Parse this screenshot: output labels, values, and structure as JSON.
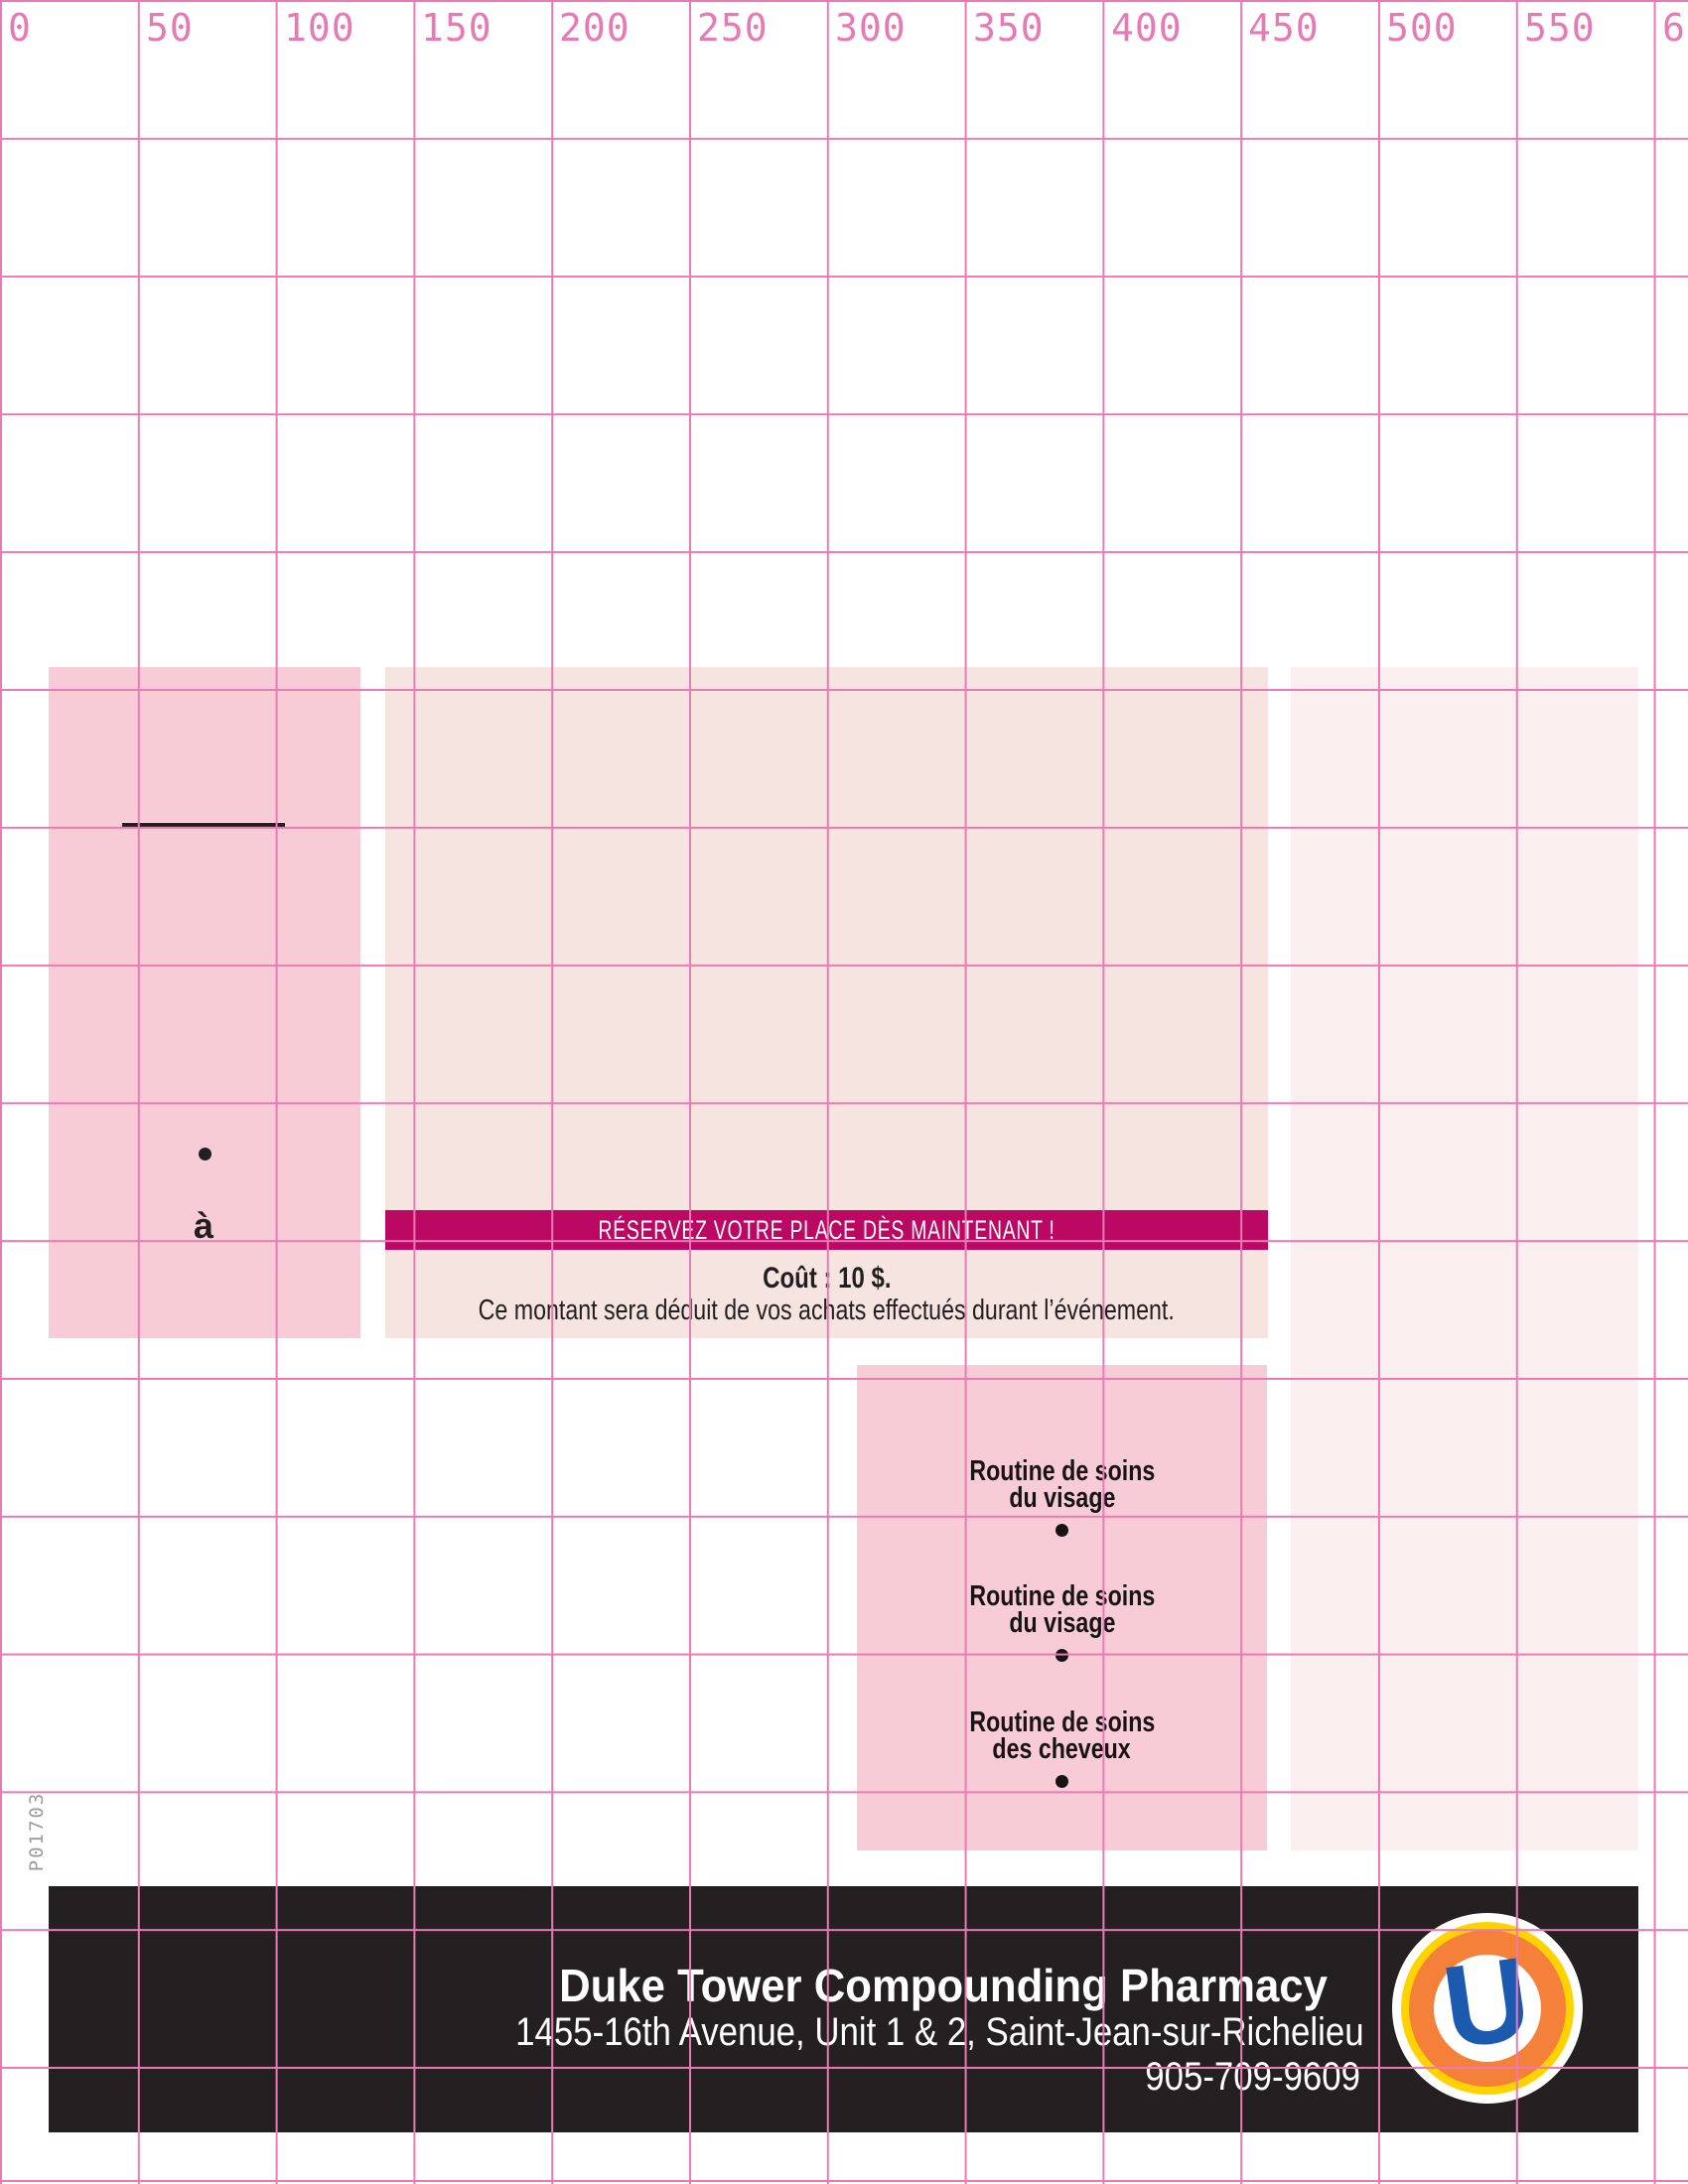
{
  "ruler": {
    "labels": [
      "0",
      "50",
      "100",
      "150",
      "200",
      "250",
      "300",
      "350",
      "400",
      "450",
      "500",
      "550",
      "600"
    ]
  },
  "plate_code": "P01703",
  "left_block": {
    "preposition": "à"
  },
  "banner": {
    "text": "RÉSERVEZ VOTRE PLACE DÈS MAINTENANT !"
  },
  "pricing": {
    "cost_line": "Coût : 10 $.",
    "note": "Ce montant sera déduit de vos achats effectués durant l’événement."
  },
  "services": [
    {
      "line1": "Routine de soins",
      "line2": "du visage"
    },
    {
      "line1": "Routine de soins",
      "line2": "du visage"
    },
    {
      "line1": "Routine de soins",
      "line2": "des cheveux"
    }
  ],
  "footer": {
    "pharmacy_name": "Duke Tower Compounding Pharmacy",
    "address": "1455-16th Avenue, Unit 1 & 2, Saint-Jean-sur-Richelieu",
    "phone": "905-709-9609",
    "logo_letter": "U"
  },
  "colors": {
    "grid_line": "#ea7ab5",
    "ruler_text": "#e87ab3",
    "pink_block": "#f8ccd7",
    "center_block": "#f6e4e0",
    "right_block": "#fbeff0",
    "banner_magenta": "#bb0862",
    "footer_black": "#241f21",
    "logo_blue": "#1c5ab0",
    "logo_orange": "#f5803a",
    "logo_yellow": "#ffd200",
    "plate_gray": "#9b9b9b",
    "text_black": "#231f20"
  }
}
